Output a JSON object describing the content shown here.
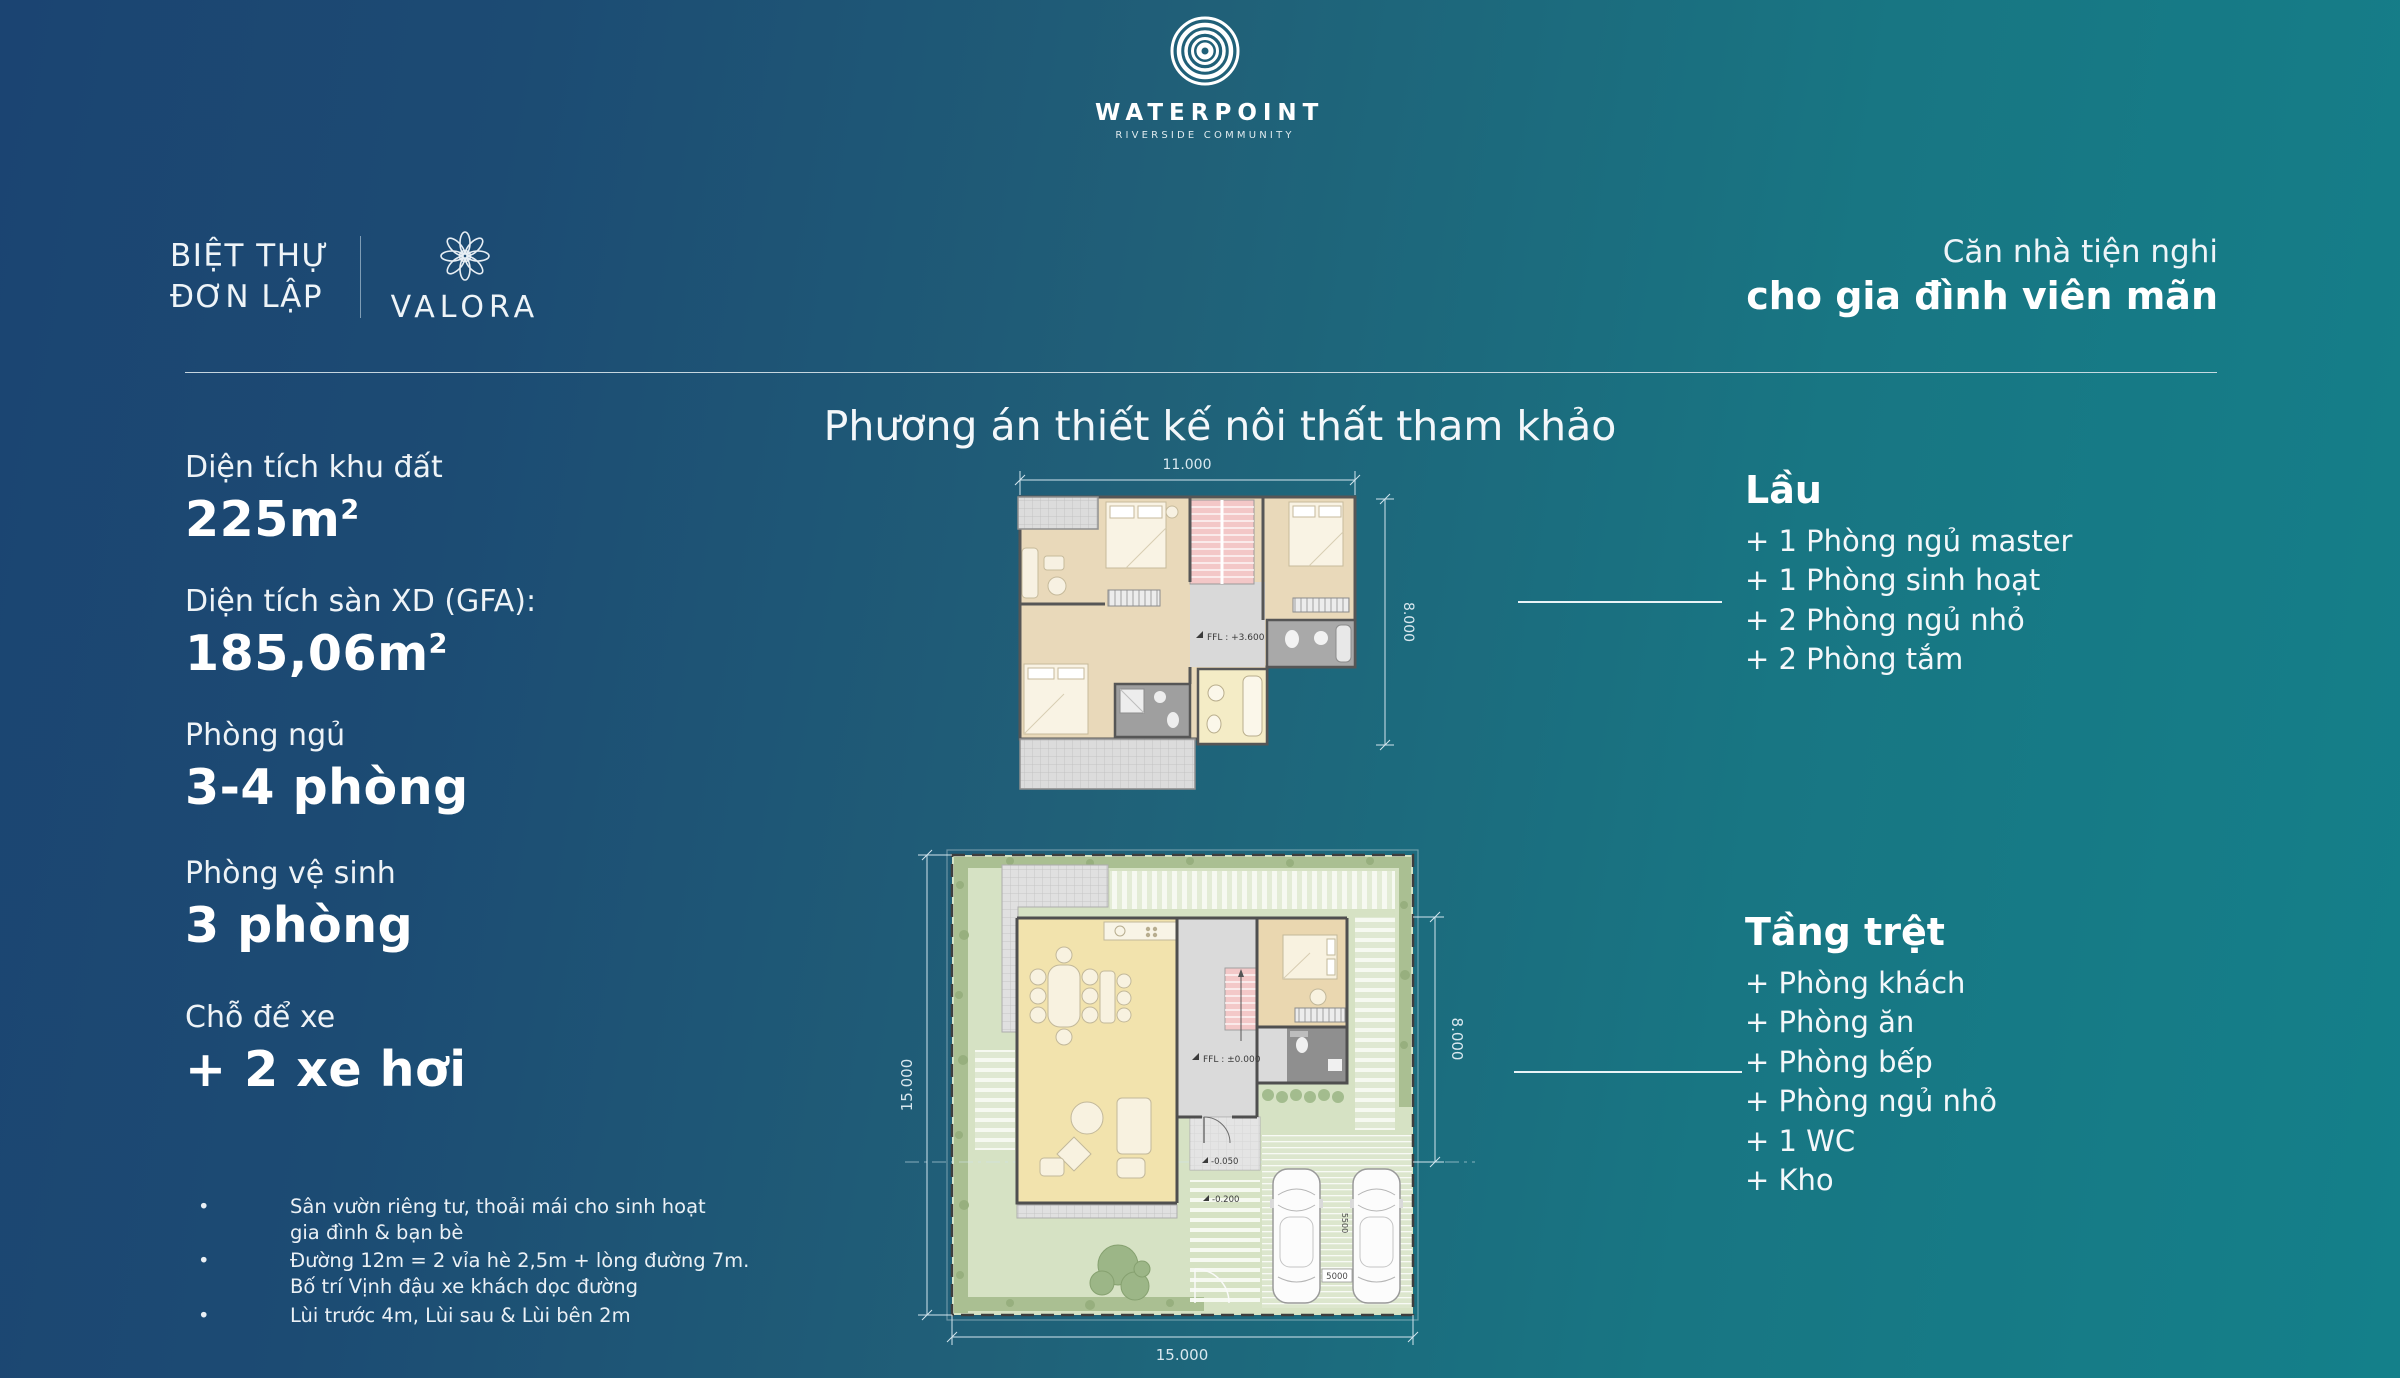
{
  "header": {
    "logo": {
      "title": "WATERPOINT",
      "subtitle": "RIVERSIDE COMMUNITY"
    },
    "product": {
      "line1": "BIỆT THỰ",
      "line2": "ĐƠN LẬP",
      "brand": "VALORA"
    },
    "tagline": {
      "line1": "Căn nhà tiện nghi",
      "line2": "cho gia đình viên mãn"
    }
  },
  "specs": {
    "items": [
      {
        "label": "Diện tích khu đất",
        "value": "225m",
        "sup": "2"
      },
      {
        "label": "Diện tích sàn XD (GFA):",
        "value": "185,06m",
        "sup": "2"
      },
      {
        "label": "Phòng ngủ",
        "value": "3-4 phòng",
        "sup": ""
      },
      {
        "label": "Phòng vệ sinh",
        "value": "3 phòng",
        "sup": ""
      },
      {
        "label": "Chỗ để xe",
        "value": "+ 2 xe hơi",
        "sup": ""
      }
    ],
    "notes": [
      {
        "line1": "Sân vườn riêng tư, thoải mái cho sinh hoạt",
        "line2": "gia đình & bạn bè"
      },
      {
        "line1": "Đường 12m = 2 vỉa hè 2,5m + lòng đường 7m.",
        "line2": "Bố trí Vịnh đậu xe khách dọc đường"
      },
      {
        "line1": "Lùi trước 4m, Lùi sau & Lùi bên 2m",
        "line2": ""
      }
    ]
  },
  "plans": {
    "heading": "Phương án thiết kế nôi thất tham khảo",
    "upper_plan": {
      "width_dim": "11.000",
      "depth_dim": "8.000",
      "ffl": "FFL : +3.600"
    },
    "ground_plan": {
      "lot_width_dim": "15.000",
      "lot_depth_dim": "15.000",
      "house_depth_dim": "8.000",
      "ffl": "FFL : ±0.000",
      "porch_level": "-0.050",
      "walk_level": "-0.200",
      "car_space_width": "5500",
      "car_space_length": "5000"
    }
  },
  "floors": {
    "upper": {
      "title": "Lầu",
      "items": [
        "+ 1 Phòng ngủ master",
        "+ 1 Phòng sinh hoạt",
        "+ 2 Phòng ngủ nhỏ",
        "+ 2 Phòng tắm"
      ]
    },
    "ground": {
      "title": "Tầng trệt",
      "items": [
        "+ Phòng khách",
        "+ Phòng ăn",
        "+ Phòng bếp",
        "+ Phòng ngủ nhỏ",
        "+ 1 WC",
        "+ Kho"
      ]
    }
  },
  "colors": {
    "bg_left": "#1b4573",
    "bg_right": "#14808a",
    "text": "#ffffff",
    "stair_pink": "#f3c7c7",
    "room_beige": "#e9d9ba",
    "garden_green": "#d6e2c4"
  }
}
